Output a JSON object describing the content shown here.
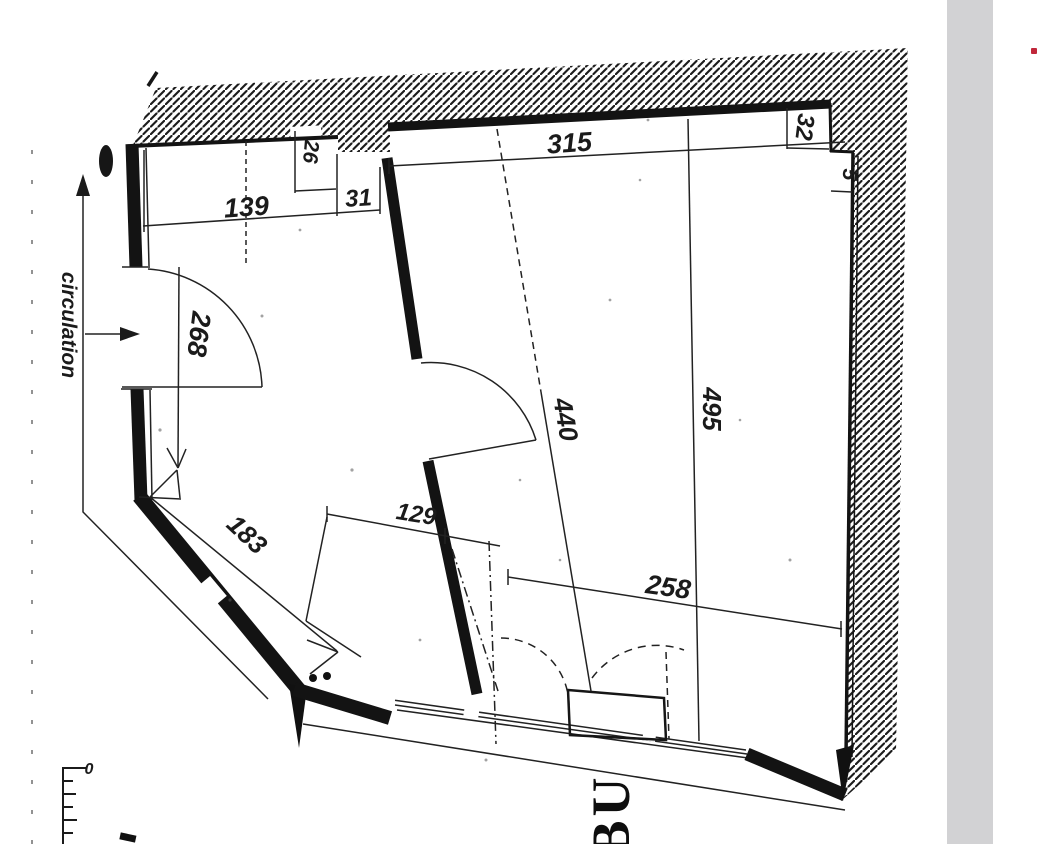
{
  "document": {
    "type": "scanned-floor-plan"
  },
  "colors": {
    "ink": "#1b1b1b",
    "paper": "#ffffff",
    "gray_strip": "#d2d2d4",
    "red_mark": "#c0273a"
  },
  "annotations": {
    "circulation": "circulation",
    "room_label_partial": "BU",
    "scale_zero": "0"
  },
  "dimensions": {
    "d139": "139",
    "d31": "31",
    "d26": "26",
    "d315": "315",
    "d32": "32",
    "d5": "5",
    "d268": "268",
    "d440": "440",
    "d495": "495",
    "d129": "129",
    "d183": "183",
    "d258": "258"
  }
}
